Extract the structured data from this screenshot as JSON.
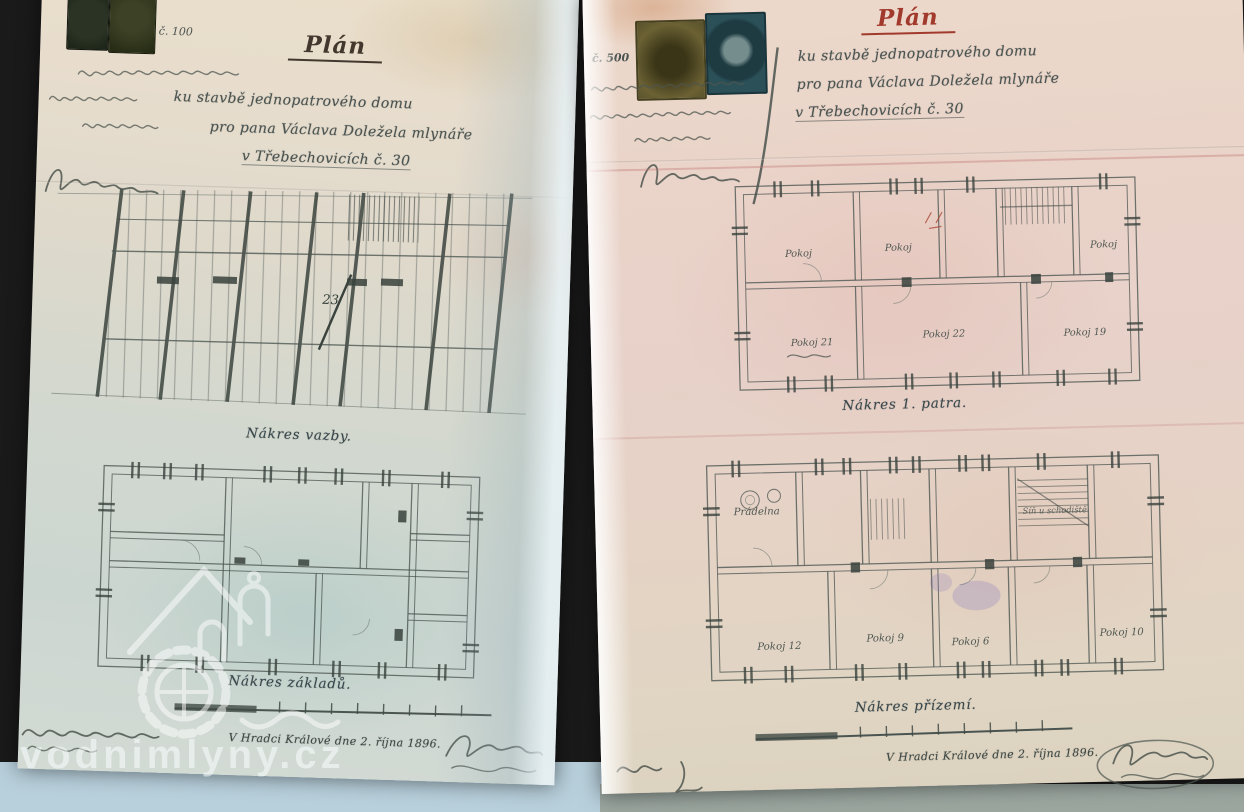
{
  "colors": {
    "backdrop": "#1a1a1a",
    "table_blue": "#b8d0dc",
    "table_gray": "#9ba69f",
    "paper_left": "#e4dbcb",
    "paper_right": "#e9d6ca",
    "ink": "#46504b",
    "title_red": "#a13a2c"
  },
  "watermark": {
    "text": "vodnimlyny.cz"
  },
  "left_page": {
    "stamp_note": "č. 100",
    "title": "Plán",
    "line1": "ku stavbě jednopatrového domu",
    "line2": "pro pana Václava Doležela mlynáře",
    "line3": "v Třebechovicích č. 30",
    "truss_number": "23",
    "caption_top": "Nákres vazby.",
    "caption_bottom": "Nákres základů.",
    "date_line": "V Hradci Králové dne 2. října 1896."
  },
  "right_page": {
    "stamp_note": "č. 500",
    "title": "Plán",
    "line1": "ku stavbě jednopatrového domu",
    "line2": "pro pana Václava Doležela mlynáře",
    "line3": "v Třebechovicích č. 30",
    "caption_top": "Nákres 1. patra.",
    "caption_bottom": "Nákres přízemí.",
    "date_line": "V Hradci Králové dne 2. října 1896.",
    "floor1_rooms": [
      "Pokoj",
      "Pokoj",
      "Pokoj",
      "Pokoj 21",
      "Pokoj 22",
      "Pokoj 19"
    ],
    "floor2_rooms": [
      "Prádelna",
      "Síň u schodiště",
      "Pokoj 12",
      "Pokoj 9",
      "Pokoj 6",
      "Pokoj 10"
    ]
  }
}
